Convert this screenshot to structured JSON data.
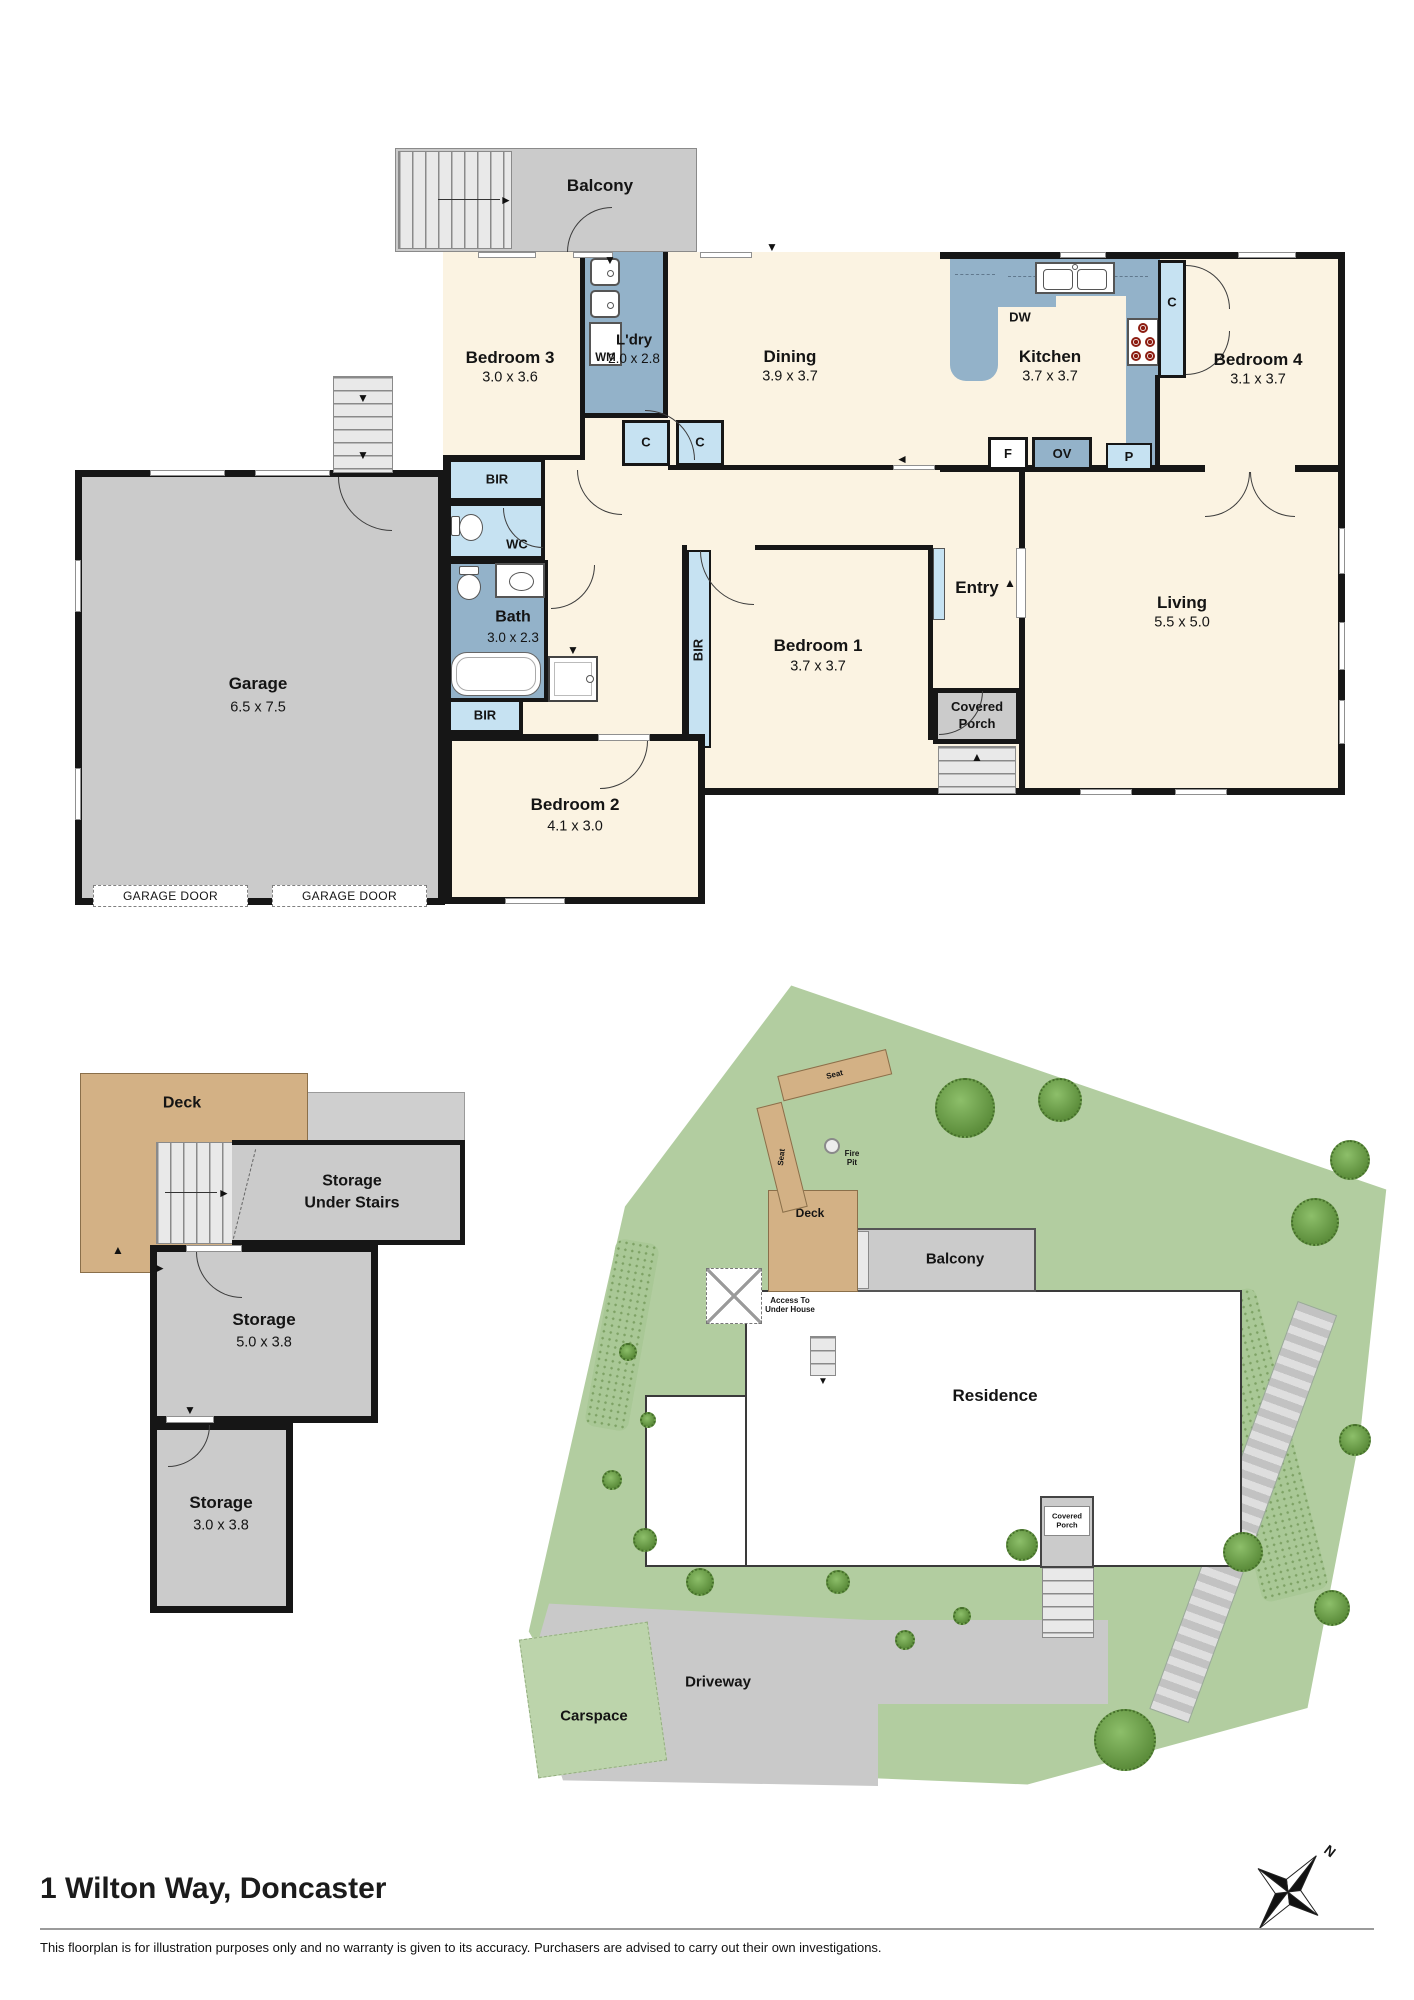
{
  "palette": {
    "cream": "#FBF3E2",
    "gray": "#CBCBCB",
    "blue_mid": "#93B2C9",
    "blue_light": "#C6E2F2",
    "tan": "#D3B185",
    "lawn_green": "#B2CDA0",
    "tree_green": "#5D8E3C",
    "wall_black": "#161616",
    "path_gray": "#C9C9C9"
  },
  "icons": {
    "arrow_up": "▲",
    "arrow_down": "▼",
    "arrow_left": "◄",
    "arrow_right": "►"
  },
  "compass": {
    "north": "N"
  },
  "floorplan": {
    "balcony": {
      "name": "Balcony"
    },
    "bedroom3": {
      "name": "Bedroom 3",
      "dims": "3.0 x 3.6"
    },
    "laundry": {
      "name": "L'dry",
      "dims": "2.0 x 2.8",
      "washer": "WM"
    },
    "dining": {
      "name": "Dining",
      "dims": "3.9 x 3.7"
    },
    "kitchen": {
      "name": "Kitchen",
      "dims": "3.7 x 3.7",
      "dishwasher": "DW",
      "fridge": "F",
      "oven": "OV",
      "pantry": "P"
    },
    "bedroom4": {
      "name": "Bedroom 4",
      "dims": "3.1 x 3.7"
    },
    "closet": "C",
    "robe": "BIR",
    "wc": {
      "name": "WC"
    },
    "bath": {
      "name": "Bath",
      "dims": "3.0 x 2.3"
    },
    "bedroom1": {
      "name": "Bedroom 1",
      "dims": "3.7 x 3.7"
    },
    "bedroom2": {
      "name": "Bedroom 2",
      "dims": "4.1 x 3.0"
    },
    "entry": {
      "name": "Entry"
    },
    "living": {
      "name": "Living",
      "dims": "5.5 x 5.0"
    },
    "covered_porch": {
      "name": "Covered Porch"
    },
    "garage": {
      "name": "Garage",
      "dims": "6.5 x 7.5",
      "door_label": "GARAGE DOOR"
    }
  },
  "storage_plan": {
    "deck": {
      "name": "Deck"
    },
    "under_stairs": {
      "line1": "Storage",
      "line2": "Under Stairs"
    },
    "storage_mid": {
      "name": "Storage",
      "dims": "5.0 x 3.8"
    },
    "storage_low": {
      "name": "Storage",
      "dims": "3.0 x 3.8"
    }
  },
  "site_plan": {
    "residence": "Residence",
    "balcony": "Balcony",
    "deck": "Deck",
    "seat": "Seat",
    "fire_pit": "Fire Pit",
    "access_stairs": "Access To Under House",
    "covered_porch": "Covered Porch",
    "driveway": "Driveway",
    "carspace": "Carspace"
  },
  "footer": {
    "title": "1 Wilton Way, Doncaster",
    "disclaimer": "This floorplan is for illustration purposes only and no warranty is given to its accuracy. Purchasers are advised to carry out their own investigations."
  }
}
